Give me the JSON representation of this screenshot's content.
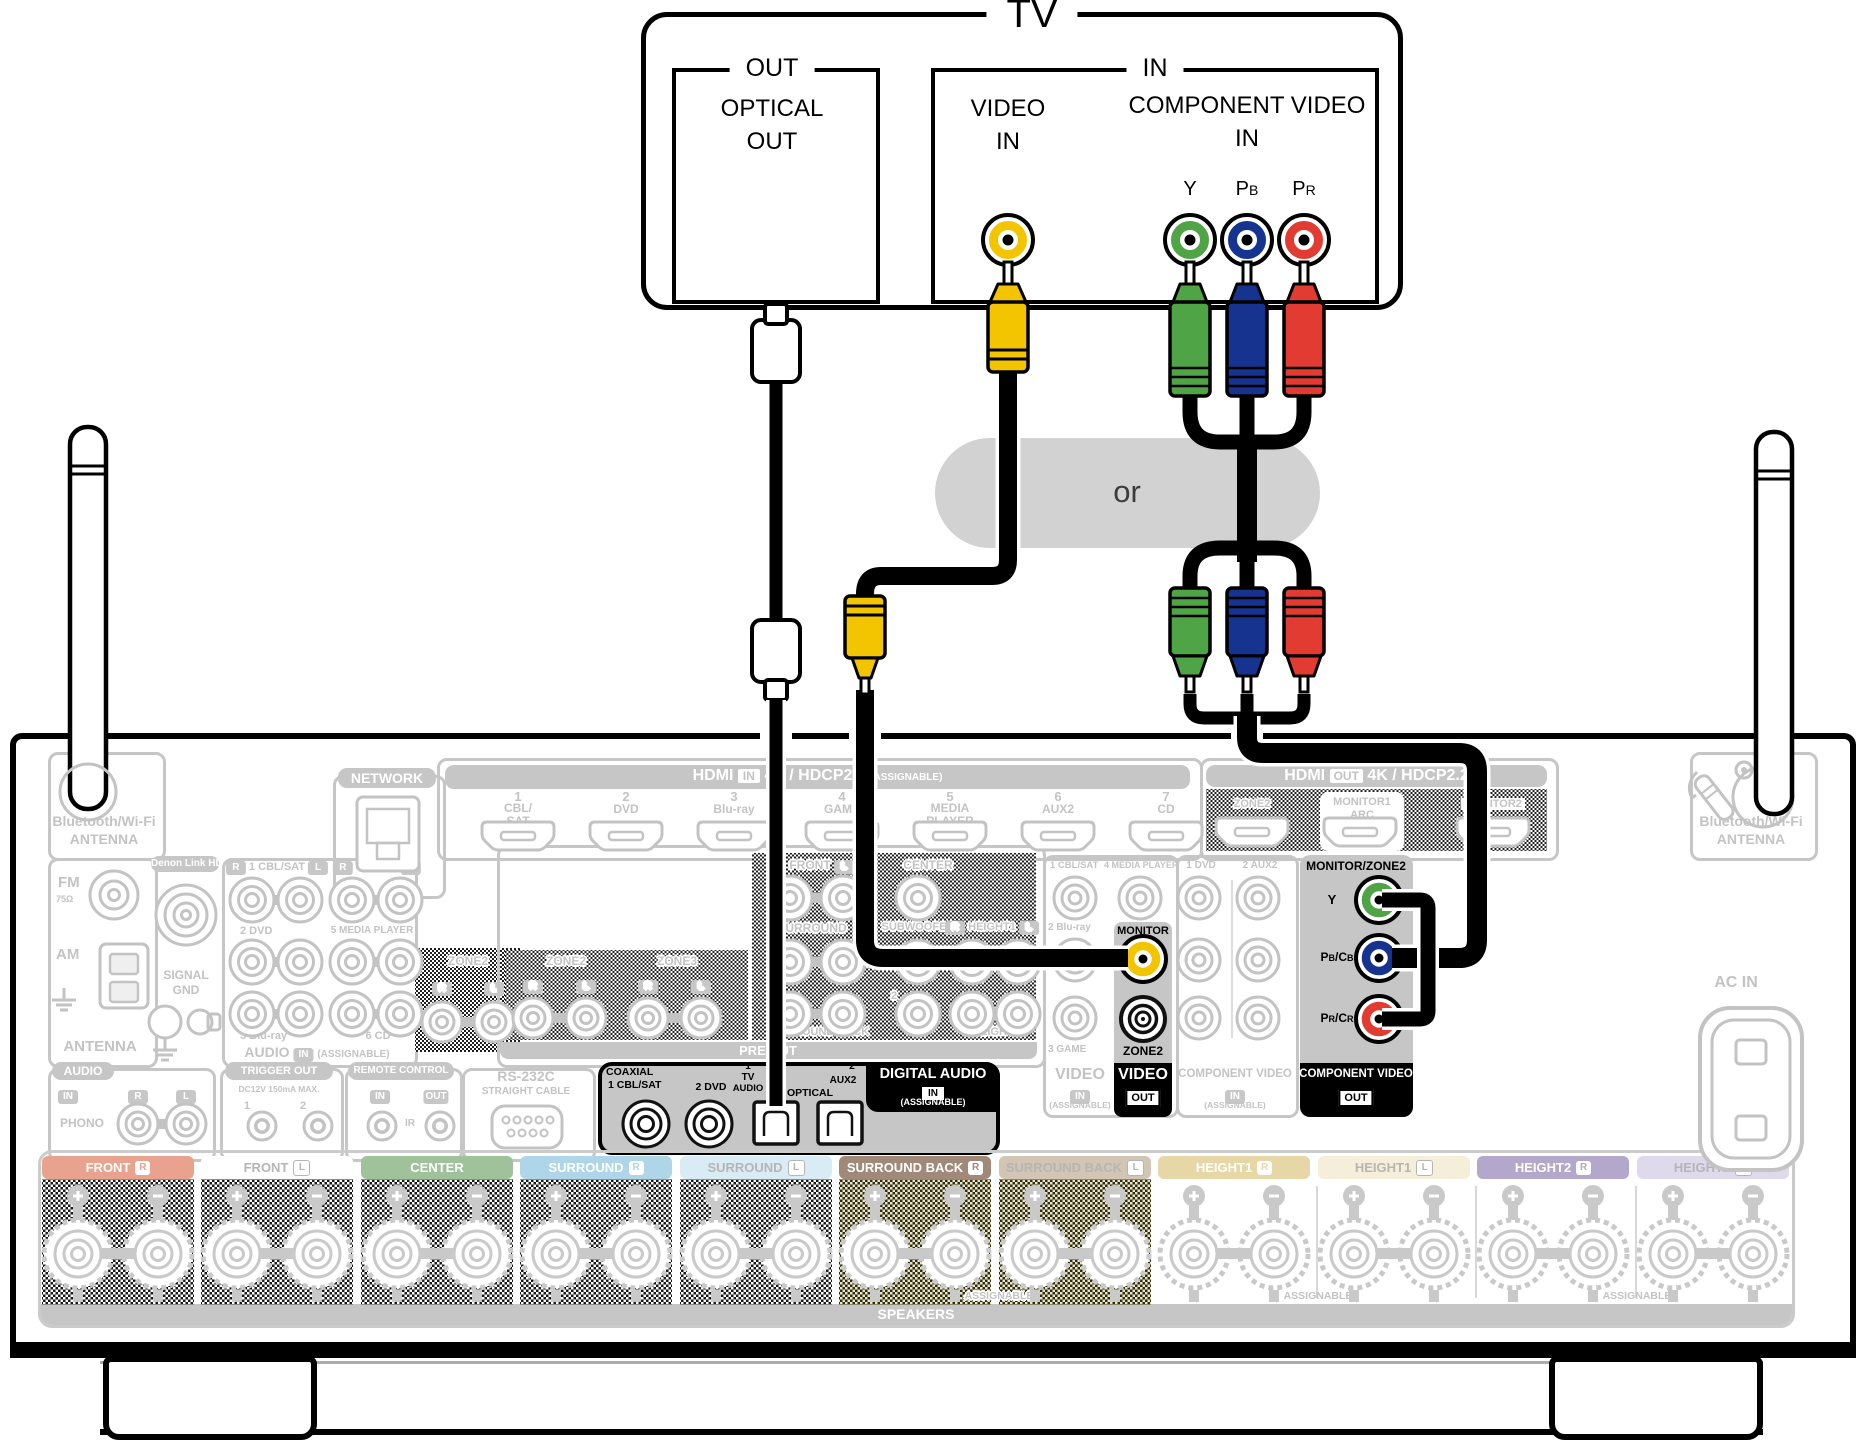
{
  "colors": {
    "highlight_gray": "#c6c6c6",
    "video_yellow": "#f2c500",
    "component_green": "#4fa446",
    "component_blue": "#16338f",
    "component_red": "#e23b31"
  },
  "common": {
    "r": "R",
    "l": "L",
    "in": "IN",
    "out": "OUT"
  },
  "or_label": "or",
  "tv": {
    "title": "TV",
    "out": {
      "group": "OUT",
      "line1": "OPTICAL",
      "line2": "OUT"
    },
    "in": {
      "group": "IN",
      "video1": "VIDEO",
      "video2": "IN",
      "comp": "COMPONENT VIDEO",
      "comp_in": "IN",
      "y": "Y",
      "pb": {
        "a": "P",
        "b": "B"
      },
      "pr": {
        "a": "P",
        "b": "R"
      }
    }
  },
  "network": "NETWORK",
  "bt": {
    "line1": "Bluetooth/Wi-Fi",
    "line2": "ANTENNA"
  },
  "hdmi_in": {
    "name": "HDMI",
    "badge": "IN",
    "spec": "4K / HDCP2.2",
    "assignable": "(ASSIGNABLE)",
    "ports": [
      {
        "num": "1",
        "l1": "CBL/",
        "l2": "SAT"
      },
      {
        "num": "2",
        "l1": "DVD"
      },
      {
        "num": "3",
        "l1": "Blu-ray"
      },
      {
        "num": "4",
        "l1": "GAME"
      },
      {
        "num": "5",
        "l1": "MEDIA",
        "l2": "PLAYER"
      },
      {
        "num": "6",
        "l1": "AUX2"
      },
      {
        "num": "7",
        "l1": "CD"
      }
    ]
  },
  "hdmi_out": {
    "name": "HDMI",
    "badge": "OUT",
    "spec": "4K / HDCP2.2",
    "zone2": "ZONE2",
    "monitor1": "MONITOR1",
    "arc": "ARC",
    "monitor2": "MONITOR2"
  },
  "antenna_box": {
    "fm": "FM",
    "ohm": "75Ω",
    "am": "AM",
    "label": "ANTENNA"
  },
  "denon": {
    "label": "Denon Link HD",
    "gnd1": "SIGNAL",
    "gnd2": "GND"
  },
  "audio_in": {
    "p1": "1 CBL/SAT",
    "p2": "4 GAME",
    "r2a": "2 DVD",
    "r2b": "5 MEDIA PLAYER",
    "r3a": "3 Blu-ray",
    "r3b": "6 CD",
    "footer": "AUDIO",
    "assignable": "(ASSIGNABLE)"
  },
  "zone2_audio": {
    "label": "ZONE2"
  },
  "pre_out": {
    "zone2": "ZONE2",
    "zone3": "ZONE3",
    "front": "FRONT",
    "center": "CENTER",
    "surround": "SURROUND",
    "subwoofer": "SUBWOOFER",
    "height1": "HEIGHT1",
    "sub2": "2",
    "surround_back": "SURROUND BACK",
    "height2": "HEIGHT2",
    "band": "PRE OUT"
  },
  "phono_box": {
    "label": "AUDIO",
    "phono": "PHONO"
  },
  "trigger": {
    "label": "TRIGGER OUT",
    "spec": "DC12V 150mA MAX.",
    "n1": "1",
    "n2": "2"
  },
  "remote": {
    "label": "REMOTE CONTROL",
    "ir": "IR"
  },
  "rs232": {
    "label": "RS-232C",
    "sub": "STRAIGHT CABLE"
  },
  "digital": {
    "coaxial": "COAXIAL",
    "c1": "1 CBL/SAT",
    "c2": "2 DVD",
    "o1a": "1",
    "o1b": "TV",
    "o1c": "AUDIO",
    "optical": "OPTICAL",
    "o2a": "2",
    "o2b": "AUX2",
    "title": "DIGITAL AUDIO",
    "assignable": "(ASSIGNABLE)"
  },
  "video_in": {
    "p1": "1 CBL/SAT",
    "p4": "4 MEDIA PLAYER",
    "p2": "2 Blu-ray",
    "p3": "3 GAME",
    "title": "VIDEO",
    "assignable": "(ASSIGNABLE)"
  },
  "video_out": {
    "monitor": "MONITOR",
    "zone2": "ZONE2",
    "title": "VIDEO"
  },
  "comp_in": {
    "p1": "1 DVD",
    "p2": "2 AUX2",
    "title": "COMPONENT VIDEO",
    "assignable": "(ASSIGNABLE)"
  },
  "comp_out": {
    "header": "MONITOR/ZONE2",
    "y": "Y",
    "pb": {
      "a": "P",
      "b": "B",
      "c": "/C",
      "d": "B"
    },
    "pr": {
      "a": "P",
      "b": "R",
      "c": "/C",
      "d": "R"
    },
    "title": "COMPONENT VIDEO"
  },
  "ac_in": "AC IN",
  "speakers": {
    "band": "SPEAKERS",
    "assignable": "ASSIGNABLE",
    "tabs": [
      {
        "label": "FRONT",
        "side": "R",
        "bg": "#e9a28e",
        "fg": "#ffffff"
      },
      {
        "label": "FRONT",
        "side": "L",
        "bg": "#ffffff",
        "fg": "#b5b5b5"
      },
      {
        "label": "CENTER",
        "side": "",
        "bg": "#9fc29b",
        "fg": "#ffffff"
      },
      {
        "label": "SURROUND",
        "side": "R",
        "bg": "#aed6e8",
        "fg": "#ffffff"
      },
      {
        "label": "SURROUND",
        "side": "L",
        "bg": "#d9ecf5",
        "fg": "#b5b5b5"
      },
      {
        "label": "SURROUND BACK",
        "side": "R",
        "bg": "#a1897a",
        "fg": "#ffffff"
      },
      {
        "label": "SURROUND BACK",
        "side": "L",
        "bg": "#d3c5b4",
        "fg": "#b5b5b5"
      },
      {
        "label": "HEIGHT1",
        "side": "R",
        "bg": "#e7d7a6",
        "fg": "#ffffff"
      },
      {
        "label": "HEIGHT1",
        "side": "L",
        "bg": "#f5efd9",
        "fg": "#b5b5b5"
      },
      {
        "label": "HEIGHT2",
        "side": "R",
        "bg": "#b4a7cc",
        "fg": "#ffffff"
      },
      {
        "label": "HEIGHT2",
        "side": "L",
        "bg": "#dfd9ec",
        "fg": "#b5b5b5"
      }
    ]
  }
}
